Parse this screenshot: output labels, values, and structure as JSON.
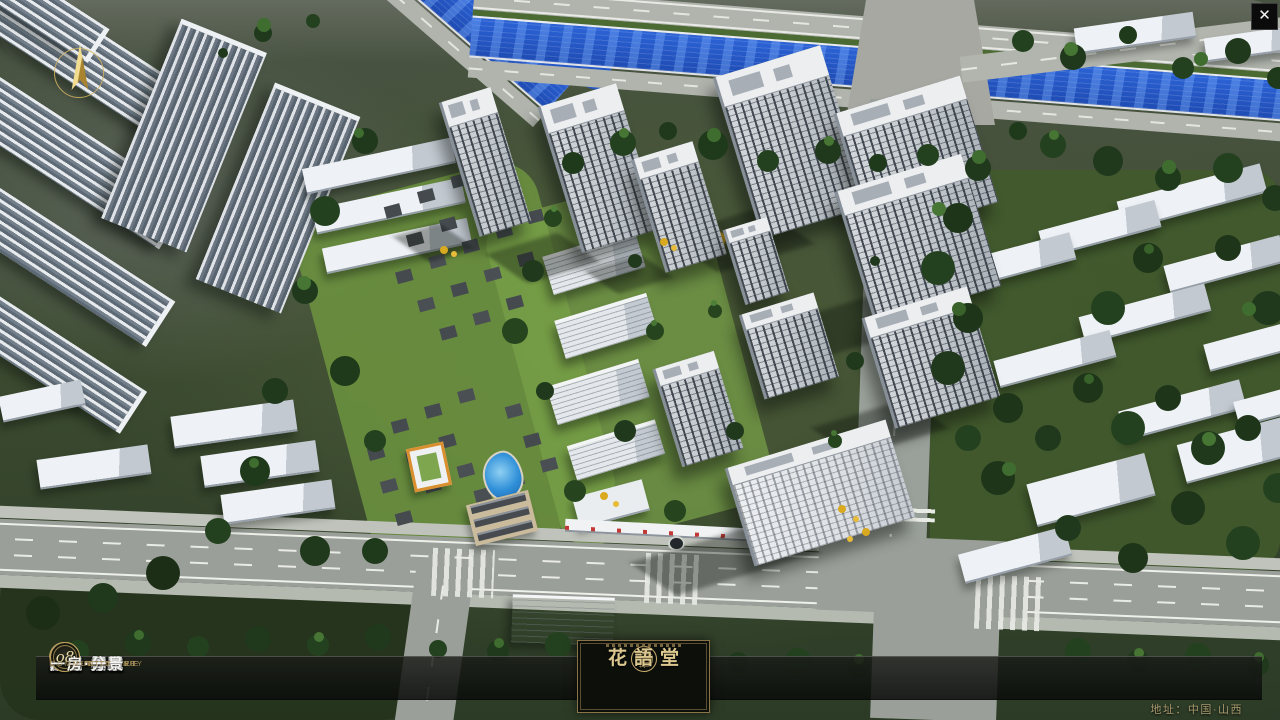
{
  "app": {
    "close_label": "✕",
    "address": "地址：中国·山西"
  },
  "logo": {
    "name": "花語堂"
  },
  "navbar": {
    "items": [
      {
        "num": "o1",
        "zh": "品牌·介绍",
        "en": "BRAND SUPPORT"
      },
      {
        "num": "o2",
        "zh": "区位·价值",
        "en": "LOCATION VALUE"
      },
      {
        "num": "o3",
        "zh": "项目·概况",
        "en": "PROJECT SURVEY"
      },
      {
        "num": "o4",
        "zh": "建筑·鉴赏",
        "en": "APPRECIATION"
      },
      {
        "num": "o5",
        "zh": "园林·景观",
        "en": "GARDEN STREET"
      },
      {
        "num": "o6",
        "zh": "精装·体验",
        "en": "EXPERIENCE"
      },
      {
        "num": "o7",
        "zh": "户型·分布",
        "en": "SHOW ROOM"
      },
      {
        "num": "o8",
        "zh": "一房·一景",
        "en": "COMMUNITY"
      }
    ]
  },
  "colors": {
    "accent_gold": "#C9AD6D",
    "bar_bg": "#0E100C",
    "river_blue": "#2558C6",
    "text_zh": "#F4F4F2",
    "text_en": "#A8905A"
  }
}
